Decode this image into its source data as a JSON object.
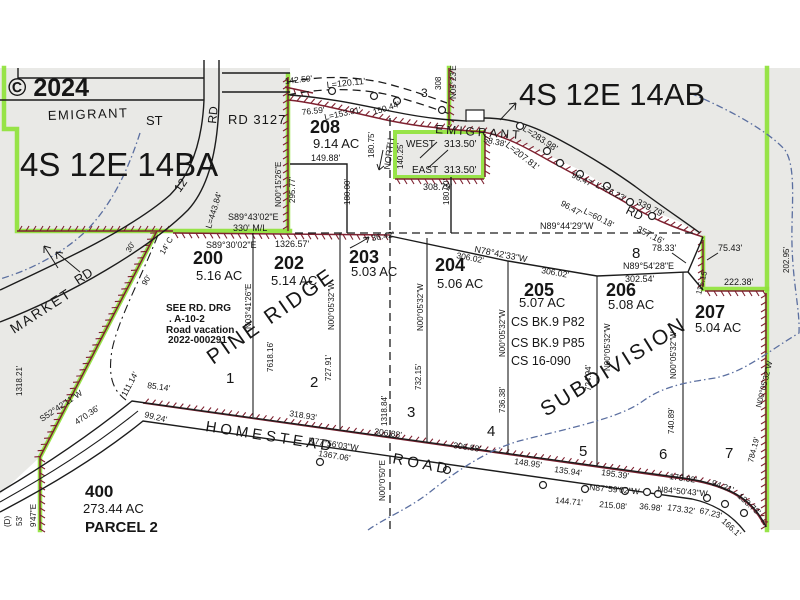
{
  "map": {
    "watermark": "© 2024",
    "section_left": "4S 12E 14BA",
    "section_right": "4S 12E 14AB",
    "labels": {
      "roads": [
        {
          "t": "EMIGRANT",
          "x": 48,
          "y": 120,
          "s": 13,
          "ls": 1.5,
          "r": -2
        },
        {
          "t": "ST",
          "x": 146,
          "y": 125,
          "s": 13
        },
        {
          "t": "RD",
          "x": 216,
          "y": 124,
          "s": 12,
          "r": -84
        },
        {
          "t": "RD 3127",
          "x": 228,
          "y": 124,
          "s": 13,
          "ls": 1
        },
        {
          "t": "MARKET",
          "x": 14,
          "y": 334,
          "s": 14,
          "r": -33,
          "ls": 2
        },
        {
          "t": "RD",
          "x": 78,
          "y": 285,
          "s": 13,
          "r": -33
        },
        {
          "t": "12",
          "x": 180,
          "y": 193,
          "s": 12,
          "r": -55
        },
        {
          "t": "EMIGRANT",
          "x": 435,
          "y": 133,
          "s": 12,
          "ls": 3,
          "r": 4
        },
        {
          "t": "RD",
          "x": 625,
          "y": 213,
          "s": 12,
          "r": 26
        },
        {
          "t": "HOMESTEAD",
          "x": 205,
          "y": 431,
          "s": 15,
          "r": 9,
          "ls": 4
        },
        {
          "t": "ROAD",
          "x": 392,
          "y": 463,
          "s": 15,
          "r": 11,
          "ls": 4
        },
        {
          "t": "NORTH",
          "x": 390,
          "y": 170,
          "s": 9,
          "r": -83
        }
      ],
      "parcels": [
        {
          "t": "208",
          "x": 310,
          "y": 133,
          "s": 18,
          "w": 600
        },
        {
          "t": "9.14 AC",
          "x": 313,
          "y": 148,
          "s": 13
        },
        {
          "t": "200",
          "x": 193,
          "y": 264,
          "s": 18,
          "w": 600
        },
        {
          "t": "5.16 AC",
          "x": 196,
          "y": 280,
          "s": 13
        },
        {
          "t": "202",
          "x": 274,
          "y": 269,
          "s": 18,
          "w": 600
        },
        {
          "t": "5.14 AC",
          "x": 271,
          "y": 285,
          "s": 13
        },
        {
          "t": "203",
          "x": 349,
          "y": 263,
          "s": 18,
          "w": 600
        },
        {
          "t": "5.03 AC",
          "x": 351,
          "y": 276,
          "s": 13
        },
        {
          "t": "204",
          "x": 435,
          "y": 271,
          "s": 18,
          "w": 600
        },
        {
          "t": "5.06 AC",
          "x": 437,
          "y": 288,
          "s": 13
        },
        {
          "t": "205",
          "x": 524,
          "y": 296,
          "s": 18,
          "w": 600
        },
        {
          "t": "5.07 AC",
          "x": 519,
          "y": 307,
          "s": 13
        },
        {
          "t": "206",
          "x": 606,
          "y": 296,
          "s": 18,
          "w": 600
        },
        {
          "t": "5.08 AC",
          "x": 608,
          "y": 309,
          "s": 13
        },
        {
          "t": "207",
          "x": 695,
          "y": 318,
          "s": 18,
          "w": 600
        },
        {
          "t": "5.04 AC",
          "x": 695,
          "y": 332,
          "s": 13
        },
        {
          "t": "400",
          "x": 85,
          "y": 497,
          "s": 17,
          "w": 600
        },
        {
          "t": "273.44 AC",
          "x": 83,
          "y": 513,
          "s": 13
        },
        {
          "t": "PARCEL 2",
          "x": 85,
          "y": 532,
          "s": 15,
          "w": 600
        }
      ],
      "lots": [
        {
          "t": "1",
          "x": 226,
          "y": 383,
          "s": 15
        },
        {
          "t": "2",
          "x": 310,
          "y": 387,
          "s": 15
        },
        {
          "t": "3",
          "x": 407,
          "y": 417,
          "s": 15
        },
        {
          "t": "4",
          "x": 487,
          "y": 436,
          "s": 15
        },
        {
          "t": "5",
          "x": 579,
          "y": 456,
          "s": 15
        },
        {
          "t": "6",
          "x": 659,
          "y": 459,
          "s": 15
        },
        {
          "t": "7",
          "x": 725,
          "y": 458,
          "s": 15
        },
        {
          "t": "8",
          "x": 632,
          "y": 258,
          "s": 15
        }
      ],
      "plat": [
        {
          "t": "PINE RIDGE",
          "x": 213,
          "y": 365,
          "s": 21,
          "r": -35,
          "ls": 3,
          "f": "#8a8a8a"
        },
        {
          "t": "SUBDIVISION",
          "x": 546,
          "y": 417,
          "s": 21,
          "r": -32,
          "ls": 3,
          "f": "#8a8a8a"
        }
      ],
      "notes": [
        {
          "t": "SEE RD. DRG",
          "x": 166,
          "y": 311,
          "s": 10,
          "w": 700
        },
        {
          "t": ". A-10-2",
          "x": 169,
          "y": 322,
          "s": 10,
          "w": 700
        },
        {
          "t": "Road vacation",
          "x": 166,
          "y": 333,
          "s": 10,
          "w": 700
        },
        {
          "t": "2022-000291",
          "x": 168,
          "y": 343,
          "s": 10,
          "w": 700
        },
        {
          "t": "CS BK.9 P82",
          "x": 511,
          "y": 326,
          "s": 12.5
        },
        {
          "t": "CS BK.9 P85",
          "x": 511,
          "y": 347,
          "s": 12.5
        },
        {
          "t": "CS 16-090",
          "x": 511,
          "y": 365,
          "s": 12.5
        }
      ],
      "measurements": [
        {
          "t": "142.50'",
          "x": 285,
          "y": 84,
          "r": -6
        },
        {
          "t": "L=120.11'",
          "x": 327,
          "y": 88,
          "r": -6,
          "s": 9
        },
        {
          "t": "3",
          "x": 421,
          "y": 97,
          "s": 12
        },
        {
          "t": "308",
          "x": 441,
          "y": 90,
          "r": -90,
          "s": 8
        },
        {
          "t": "N05°23'E",
          "x": 456,
          "y": 99,
          "r": -90,
          "s": 8
        },
        {
          "t": "76.59'",
          "x": 302,
          "y": 115,
          "r": -6
        },
        {
          "t": "L=153.91'",
          "x": 325,
          "y": 120,
          "r": -12
        },
        {
          "t": "150.44'",
          "x": 374,
          "y": 115,
          "r": -18
        },
        {
          "t": "L=283.98'",
          "x": 522,
          "y": 130,
          "r": 33,
          "s": 9
        },
        {
          "t": "L=207.81'",
          "x": 505,
          "y": 146,
          "r": 38,
          "s": 9
        },
        {
          "t": "96.47'",
          "x": 571,
          "y": 177,
          "r": 26
        },
        {
          "t": "L=76.23'",
          "x": 595,
          "y": 187,
          "r": 26
        },
        {
          "t": "339.79'",
          "x": 636,
          "y": 204,
          "r": 27,
          "s": 9
        },
        {
          "t": "96.47'",
          "x": 560,
          "y": 205,
          "r": 30
        },
        {
          "t": "L=60.18'",
          "x": 583,
          "y": 213,
          "r": 27
        },
        {
          "t": "357.16'",
          "x": 636,
          "y": 231,
          "r": 27,
          "s": 9
        },
        {
          "t": "58.38'",
          "x": 483,
          "y": 142,
          "r": 12
        },
        {
          "t": "N00°15'26\"E",
          "x": 281,
          "y": 207,
          "r": -90,
          "s": 8
        },
        {
          "t": "295.77'",
          "x": 295,
          "y": 203,
          "r": -90,
          "s": 8
        },
        {
          "t": "S89°43'02\"E",
          "x": 228,
          "y": 220,
          "s": 9
        },
        {
          "t": "330' M/L",
          "x": 233,
          "y": 231,
          "s": 9
        },
        {
          "t": "L=443.84'",
          "x": 211,
          "y": 229,
          "r": -73
        },
        {
          "t": "30'",
          "x": 130,
          "y": 253,
          "r": -60,
          "s": 8
        },
        {
          "t": "14' C",
          "x": 164,
          "y": 255,
          "r": -60,
          "s": 8
        },
        {
          "t": "90'",
          "x": 146,
          "y": 286,
          "r": -60,
          "s": 8
        },
        {
          "t": "149.88'",
          "x": 311,
          "y": 161,
          "s": 9
        },
        {
          "t": "180.00'",
          "x": 350,
          "y": 205,
          "r": -90,
          "s": 8
        },
        {
          "t": "180.75'",
          "x": 374,
          "y": 158,
          "r": -90,
          "s": 8
        },
        {
          "t": "140.25'",
          "x": 403,
          "y": 169,
          "r": -90,
          "s": 8
        },
        {
          "t": "WEST",
          "x": 406,
          "y": 147,
          "s": 10
        },
        {
          "t": "313.50'",
          "x": 444,
          "y": 147,
          "s": 10
        },
        {
          "t": "EAST",
          "x": 412,
          "y": 173,
          "s": 10
        },
        {
          "t": "313.50'",
          "x": 444,
          "y": 173,
          "s": 10
        },
        {
          "t": "308.79'",
          "x": 423,
          "y": 190,
          "s": 9
        },
        {
          "t": "180.00'",
          "x": 449,
          "y": 205,
          "r": -90,
          "s": 8
        },
        {
          "t": "S89°30'02\"E",
          "x": 206,
          "y": 248,
          "s": 9
        },
        {
          "t": "1326.57'",
          "x": 275,
          "y": 247,
          "s": 9
        },
        {
          "t": "N89°44'29\"W",
          "x": 540,
          "y": 229,
          "s": 9
        },
        {
          "t": "36.42'",
          "x": 372,
          "y": 241,
          "r": -10
        },
        {
          "t": "N78°42'33\"W",
          "x": 474,
          "y": 252,
          "r": 11,
          "s": 9
        },
        {
          "t": "306.02'",
          "x": 456,
          "y": 258,
          "r": 11
        },
        {
          "t": "306.02'",
          "x": 541,
          "y": 273,
          "r": 10
        },
        {
          "t": "N89°54'28\"E",
          "x": 623,
          "y": 269,
          "s": 9
        },
        {
          "t": "302.54'",
          "x": 625,
          "y": 282,
          "s": 9
        },
        {
          "t": "78.33'",
          "x": 652,
          "y": 251,
          "s": 9
        },
        {
          "t": "75.43'",
          "x": 718,
          "y": 251,
          "s": 9
        },
        {
          "t": "222.38'",
          "x": 724,
          "y": 285,
          "s": 9
        },
        {
          "t": "115.15'",
          "x": 701,
          "y": 295,
          "r": -75,
          "s": 8
        },
        {
          "t": "202.95'",
          "x": 789,
          "y": 273,
          "r": -90,
          "s": 8
        },
        {
          "t": "N03°41'26\"E",
          "x": 251,
          "y": 329,
          "r": -90,
          "s": 8
        },
        {
          "t": "7618.16'",
          "x": 273,
          "y": 372,
          "r": -90,
          "s": 8
        },
        {
          "t": "N00°05'32\"W",
          "x": 334,
          "y": 330,
          "r": -90,
          "s": 8
        },
        {
          "t": "727.91'",
          "x": 331,
          "y": 381,
          "r": -90,
          "s": 8
        },
        {
          "t": "N00°05'32\"W",
          "x": 423,
          "y": 331,
          "r": -90,
          "s": 8
        },
        {
          "t": "732.15'",
          "x": 421,
          "y": 390,
          "r": -90,
          "s": 8
        },
        {
          "t": "N00°05'32\"W",
          "x": 505,
          "y": 357,
          "r": -90,
          "s": 8
        },
        {
          "t": "736.38'",
          "x": 505,
          "y": 413,
          "r": -90,
          "s": 8
        },
        {
          "t": "N00°05'32\"W",
          "x": 610,
          "y": 371,
          "r": -90,
          "s": 8
        },
        {
          "t": "724.94'",
          "x": 591,
          "y": 391,
          "r": -90,
          "s": 8
        },
        {
          "t": "N00°05'32\"W",
          "x": 676,
          "y": 379,
          "r": -90,
          "s": 8
        },
        {
          "t": "740.89'",
          "x": 674,
          "y": 434,
          "r": -90,
          "s": 8
        },
        {
          "t": "N00°05'32\"W",
          "x": 761,
          "y": 408,
          "r": -76,
          "s": 8
        },
        {
          "t": "784.19'",
          "x": 753,
          "y": 463,
          "r": -76,
          "s": 8
        },
        {
          "t": "1318.84'",
          "x": 387,
          "y": 426,
          "r": -90,
          "s": 8
        },
        {
          "t": "N00°0'50\"E",
          "x": 385,
          "y": 501,
          "r": -90,
          "s": 8
        },
        {
          "t": "1318.21'",
          "x": 22,
          "y": 396,
          "r": -90,
          "s": 8
        },
        {
          "t": "S52°42'11\"W",
          "x": 42,
          "y": 422,
          "r": -34
        },
        {
          "t": "470.36'",
          "x": 77,
          "y": 425,
          "r": -34
        },
        {
          "t": "111.14'",
          "x": 126,
          "y": 397,
          "r": -62
        },
        {
          "t": "85.14'",
          "x": 147,
          "y": 388,
          "r": 8
        },
        {
          "t": "99.24'",
          "x": 144,
          "y": 417,
          "r": 14
        },
        {
          "t": "318.93'",
          "x": 289,
          "y": 416,
          "r": 9
        },
        {
          "t": "N77°56'03\"W",
          "x": 308,
          "y": 443,
          "r": 9
        },
        {
          "t": "1367.06'",
          "x": 318,
          "y": 456,
          "r": 9
        },
        {
          "t": "306.88'",
          "x": 374,
          "y": 434,
          "r": 8
        },
        {
          "t": "306.88'",
          "x": 453,
          "y": 448,
          "r": 8
        },
        {
          "t": "148.95'",
          "x": 514,
          "y": 464,
          "r": 8
        },
        {
          "t": "135.94'",
          "x": 554,
          "y": 472,
          "r": 8
        },
        {
          "t": "195.39'",
          "x": 601,
          "y": 475,
          "r": 8
        },
        {
          "t": "173.32'",
          "x": 669,
          "y": 479,
          "r": 8
        },
        {
          "t": "94.21'",
          "x": 711,
          "y": 485,
          "r": 20
        },
        {
          "t": "133.73'",
          "x": 737,
          "y": 497,
          "r": 42
        },
        {
          "t": "N87°59'02\"W",
          "x": 589,
          "y": 490,
          "r": 5
        },
        {
          "t": "N84°50'43\"W",
          "x": 657,
          "y": 492,
          "r": 5
        },
        {
          "t": "144.71'",
          "x": 555,
          "y": 503,
          "r": 5
        },
        {
          "t": "215.08'",
          "x": 599,
          "y": 507,
          "r": 5
        },
        {
          "t": "36.98'",
          "x": 639,
          "y": 509,
          "r": 5
        },
        {
          "t": "173.32'",
          "x": 667,
          "y": 510,
          "r": 8
        },
        {
          "t": "67.23'",
          "x": 699,
          "y": 513,
          "r": 14
        },
        {
          "t": "166.1'",
          "x": 721,
          "y": 522,
          "r": 42
        },
        {
          "t": "(D)",
          "x": 10,
          "y": 527,
          "r": -90,
          "s": 8
        },
        {
          "t": "53'",
          "x": 22,
          "y": 526,
          "r": -90,
          "s": 8
        },
        {
          "t": "9'47\"E",
          "x": 36,
          "y": 527,
          "r": -90,
          "s": 8
        }
      ]
    },
    "colors": {
      "highlight_green": "#8fe23a",
      "boundary_maroon": "#7e2130",
      "stream_blue": "#5b6fa0",
      "land_gray": "#e9e9e6"
    }
  }
}
